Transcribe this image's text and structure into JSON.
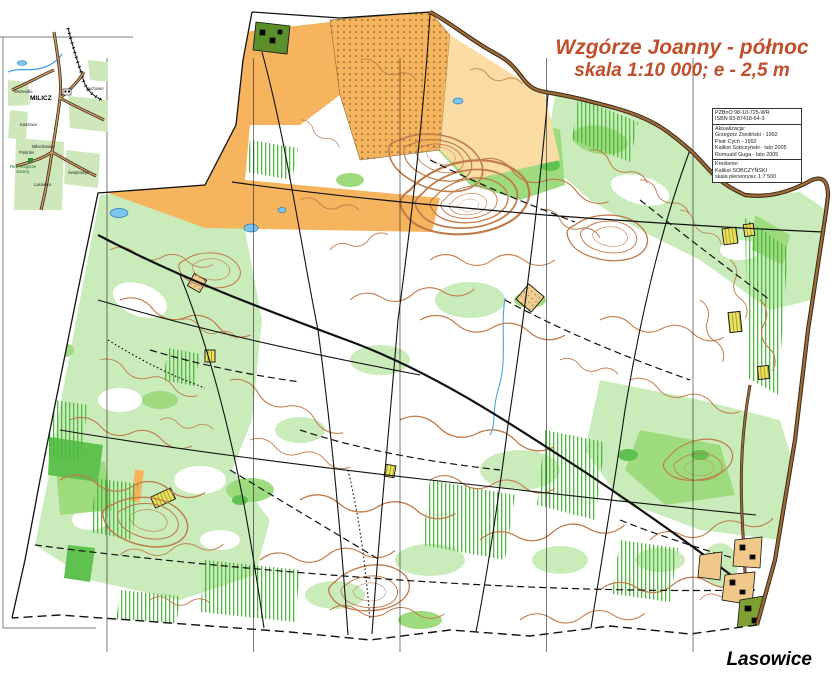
{
  "title": {
    "line1": "Wzgórze Joanny - północ",
    "line2": "skala 1:10 000; e - 2,5 m"
  },
  "credits": {
    "id_lines": [
      "PZBnO 98-10-725-WR",
      "ISBN 83-87418-64-3"
    ],
    "update_header": "Aktualizacja:",
    "update_lines": [
      "Grzegorz Zwoliński - 1992",
      "Piotr Cych - 1992",
      "Kalikst Sobczyński - lato 2005",
      "Romuald Guga - lato 2005"
    ],
    "drawing_header": "Kreślenie:",
    "drawing_lines": [
      "Kalikst SOBCZYŃSKI",
      "skala pierworysu: 1:7 500"
    ]
  },
  "inset": {
    "labels": {
      "city": "MILICZ",
      "wszewilki": "Wszewilki",
      "duchowo": "Duchowo",
      "kaszowo": "Kaszowo",
      "milochowice": "Miłochowice",
      "postolin": "Postolin",
      "reserve_line1": "Rez. Wzgórze",
      "reserve_line2": "Joanny",
      "swietoszyn": "Świętoszyn",
      "lasowice": "Lasowice"
    }
  },
  "footer": {
    "village_label": "Lasowice"
  },
  "colors": {
    "title_text": "#c14f2b",
    "contour_brown": "#c07b4a",
    "open_land_orange": "#f6b45f",
    "open_land_pale": "#fbdca4",
    "vegetation_light_green": "#c9ecba",
    "vegetation_medium_green": "#9edb7f",
    "vegetation_dark_green": "#5fc24e",
    "water_blue": "#7fc3f0",
    "road_brown": "#a06a38",
    "path_black": "#111111"
  }
}
